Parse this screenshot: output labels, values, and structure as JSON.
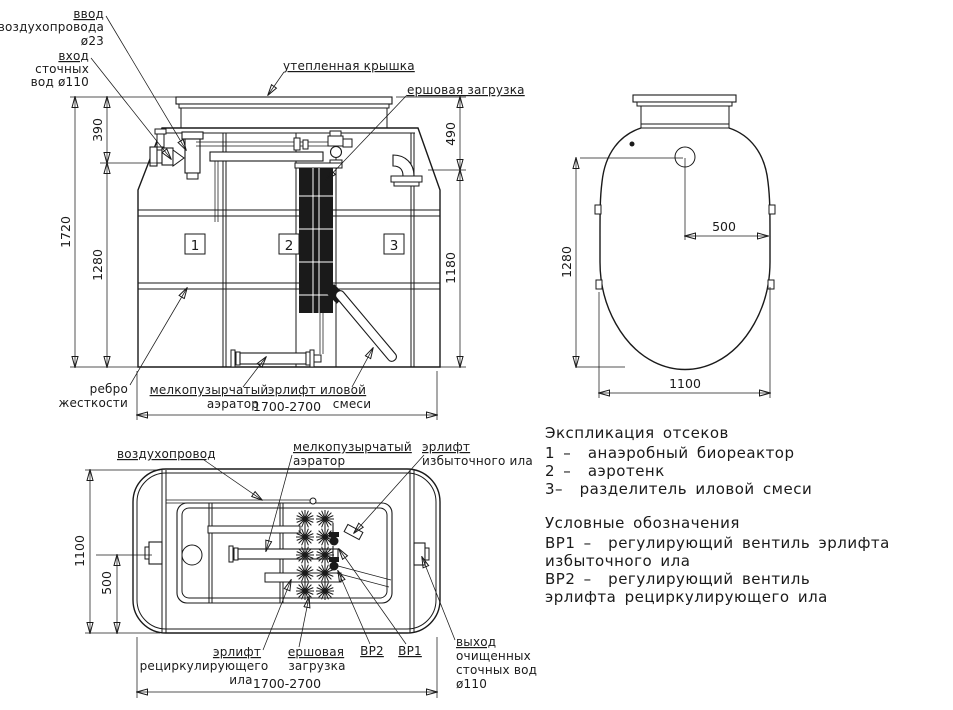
{
  "section": {
    "labels": {
      "air_inlet": [
        "ввод",
        "воздухопровода",
        "ø23"
      ],
      "sewage_inlet": [
        "вход",
        "сточных",
        "вод ø110"
      ],
      "cover": "утепленная крышка",
      "brush": "ершовая загрузка",
      "rib": [
        "ребро",
        "жесткости"
      ],
      "aerator": [
        "мелкопузырчатый",
        "аэратор"
      ],
      "sludge_airlift": [
        "эрлифт иловой",
        "смеси"
      ],
      "compartments": [
        "1",
        "2",
        "3"
      ]
    },
    "dims": {
      "d390": "390",
      "d1720": "1720",
      "d1280": "1280",
      "d490": "490",
      "d1180": "1180",
      "length": "1700-2700"
    }
  },
  "top_view": {
    "dims": {
      "d1280": "1280",
      "d500": "500",
      "d1100": "1100"
    }
  },
  "plan": {
    "labels": {
      "air_duct": "воздухопровод",
      "aerator": [
        "мелкопузырчатый",
        "аэратор"
      ],
      "excess_airlift": [
        "эрлифт",
        "избыточного ила"
      ],
      "recirc_airlift": [
        "эрлифт",
        "рециркулирующего",
        "ила"
      ],
      "brush": [
        "ершовая",
        "загрузка"
      ],
      "valve2": "ВР2",
      "valve1": "ВР1",
      "outlet": [
        "выход",
        "очищенных",
        "сточных вод",
        "ø110"
      ]
    },
    "dims": {
      "d1100": "1100",
      "d500": "500",
      "length": "1700-2700"
    }
  },
  "legend": {
    "compartments_title": "Экспликация отсеков",
    "compartments": [
      "1 –  анаэробный биореактор",
      "2 –  аэротенк",
      "3–  разделитель иловой смеси"
    ],
    "symbols_title": "Условные обозначения",
    "symbols": [
      "ВР1 –  регулирующий вентиль эрлифта",
      "избыточного ила",
      "ВР2 –  регулирующий вентиль",
      "эрлифта рециркулирующего ила"
    ]
  },
  "colors": {
    "ink": "#1a1a1a",
    "background": "#ffffff"
  }
}
